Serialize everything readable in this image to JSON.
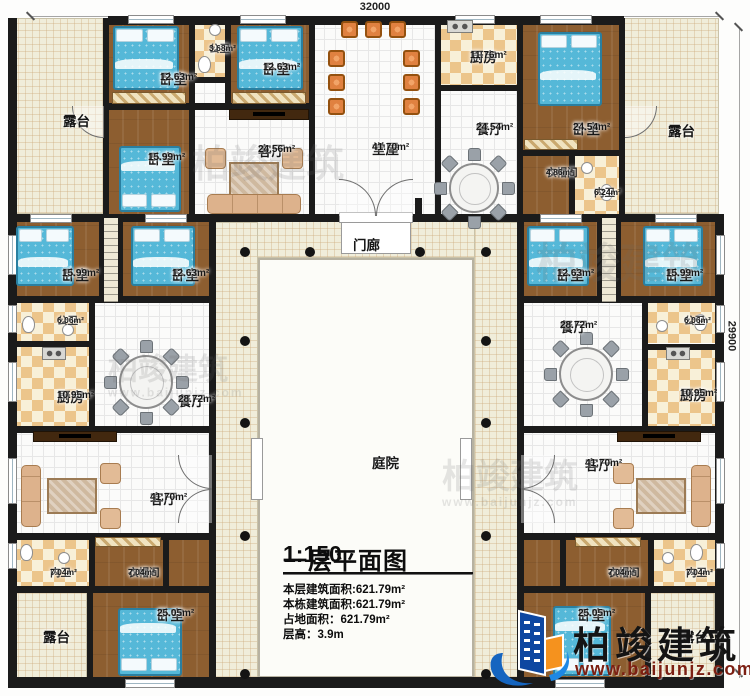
{
  "dimensions": {
    "top": "32000",
    "right": "29900"
  },
  "title_block": {
    "title": "一层平面图",
    "scale": "1:150",
    "stats": [
      "本层建筑面积:621.79m²",
      "本栋建筑面积:621.79m²",
      "占地面积：621.79m²",
      "层高：3.9m"
    ]
  },
  "logo": {
    "name": "柏竣建筑",
    "url": "www.baijunjz.com"
  },
  "watermarks": [
    {
      "x": 268,
      "y": 166,
      "size": 38,
      "with_url": false
    },
    {
      "x": 620,
      "y": 264,
      "size": 42,
      "with_url": false
    },
    {
      "x": 168,
      "y": 370,
      "size": 30,
      "with_url": true
    },
    {
      "x": 510,
      "y": 478,
      "size": 34,
      "with_url": true
    }
  ],
  "rooms": [
    {
      "name": "露台",
      "area": "",
      "type": "terrace",
      "x": 10,
      "y": 18,
      "w": 95,
      "h": 196,
      "lx": 63,
      "ly": 114
    },
    {
      "name": "卧室",
      "area": "12.63m²",
      "type": "wood",
      "x": 107,
      "y": 18,
      "w": 84,
      "h": 88,
      "lx": 160,
      "ly": 72
    },
    {
      "name": "公卫",
      "area": "3.68m²",
      "type": "checker",
      "x": 193,
      "y": 18,
      "w": 34,
      "h": 61,
      "lx": 209,
      "ly": 44,
      "small": true
    },
    {
      "name": "",
      "area": "",
      "type": "tile",
      "x": 193,
      "y": 81,
      "w": 34,
      "h": 24
    },
    {
      "name": "卧室",
      "area": "12.63m²",
      "type": "wood",
      "x": 229,
      "y": 18,
      "w": 82,
      "h": 88,
      "lx": 263,
      "ly": 62
    },
    {
      "name": "卧室",
      "area": "15.99m²",
      "type": "wood",
      "x": 107,
      "y": 108,
      "w": 84,
      "h": 108,
      "lx": 148,
      "ly": 152
    },
    {
      "name": "客厅",
      "area": "24.56m²",
      "type": "tile",
      "x": 193,
      "y": 106,
      "w": 118,
      "h": 110,
      "lx": 258,
      "ly": 144
    },
    {
      "name": "堂屋",
      "area": "41.70m²",
      "type": "tile",
      "x": 313,
      "y": 18,
      "w": 124,
      "h": 198,
      "lx": 372,
      "ly": 142
    },
    {
      "name": "厨房",
      "area": "11.76m²",
      "type": "checker",
      "x": 439,
      "y": 18,
      "w": 80,
      "h": 69,
      "lx": 470,
      "ly": 50
    },
    {
      "name": "餐厅",
      "area": "24.54m²",
      "type": "tile",
      "x": 439,
      "y": 89,
      "w": 80,
      "h": 127,
      "lx": 476,
      "ly": 122
    },
    {
      "name": "卧室",
      "area": "24.54m²",
      "type": "wood",
      "x": 521,
      "y": 18,
      "w": 100,
      "h": 134,
      "lx": 573,
      "ly": 122
    },
    {
      "name": "衣帽间",
      "area": "4.86m²",
      "type": "wood",
      "x": 521,
      "y": 156,
      "w": 50,
      "h": 60,
      "lx": 546,
      "ly": 168,
      "small": true
    },
    {
      "name": "内卫",
      "area": "6.24m²",
      "type": "checker",
      "x": 573,
      "y": 156,
      "w": 48,
      "h": 60,
      "lx": 594,
      "ly": 188,
      "small": true
    },
    {
      "name": "露台",
      "area": "",
      "type": "terrace",
      "x": 623,
      "y": 18,
      "w": 96,
      "h": 196,
      "lx": 668,
      "ly": 124
    },
    {
      "name": "门廊",
      "area": "",
      "type": "cream",
      "x": 214,
      "y": 220,
      "w": 304,
      "h": 38,
      "lx": 353,
      "ly": 238
    },
    {
      "name": "",
      "area": "",
      "type": "cream",
      "x": 214,
      "y": 222,
      "w": 44,
      "h": 456
    },
    {
      "name": "",
      "area": "",
      "type": "cream",
      "x": 474,
      "y": 222,
      "w": 44,
      "h": 456
    },
    {
      "name": "庭院",
      "area": "",
      "type": "court",
      "x": 258,
      "y": 258,
      "w": 216,
      "h": 420,
      "lx": 372,
      "ly": 456
    },
    {
      "name": "卧室",
      "area": "15.99m²",
      "type": "wood",
      "x": 10,
      "y": 220,
      "w": 89,
      "h": 78,
      "lx": 62,
      "ly": 268
    },
    {
      "name": "",
      "area": "",
      "type": "stairs",
      "x": 101,
      "y": 218,
      "w": 20,
      "h": 84
    },
    {
      "name": "卧室",
      "area": "12.63m²",
      "type": "wood",
      "x": 121,
      "y": 220,
      "w": 88,
      "h": 78,
      "lx": 172,
      "ly": 268
    },
    {
      "name": "公卫",
      "area": "6.06m²",
      "type": "checker",
      "x": 10,
      "y": 301,
      "w": 79,
      "h": 42,
      "lx": 57,
      "ly": 316,
      "small": true
    },
    {
      "name": "厨房",
      "area": "10.95m²",
      "type": "checker",
      "x": 10,
      "y": 345,
      "w": 79,
      "h": 82,
      "lx": 57,
      "ly": 390
    },
    {
      "name": "餐厅",
      "area": "28.72m²",
      "type": "tile",
      "x": 93,
      "y": 301,
      "w": 116,
      "h": 126,
      "lx": 178,
      "ly": 394
    },
    {
      "name": "卧室",
      "area": "12.63m²",
      "type": "wood",
      "x": 521,
      "y": 220,
      "w": 76,
      "h": 78,
      "lx": 557,
      "ly": 268
    },
    {
      "name": "",
      "area": "",
      "type": "stairs",
      "x": 599,
      "y": 218,
      "w": 20,
      "h": 84
    },
    {
      "name": "卧室",
      "area": "15.99m²",
      "type": "wood",
      "x": 619,
      "y": 220,
      "w": 96,
      "h": 78,
      "lx": 666,
      "ly": 268
    },
    {
      "name": "餐厅",
      "area": "28.72m²",
      "type": "tile",
      "x": 521,
      "y": 301,
      "w": 121,
      "h": 126,
      "lx": 560,
      "ly": 320
    },
    {
      "name": "公卫",
      "area": "6.06m²",
      "type": "checker",
      "x": 646,
      "y": 301,
      "w": 69,
      "h": 42,
      "lx": 684,
      "ly": 316,
      "small": true
    },
    {
      "name": "厨房",
      "area": "10.95m²",
      "type": "checker",
      "x": 646,
      "y": 347,
      "w": 69,
      "h": 80,
      "lx": 680,
      "ly": 388
    },
    {
      "name": "客厅",
      "area": "41.70m²",
      "type": "tile",
      "x": 10,
      "y": 431,
      "w": 199,
      "h": 103,
      "lx": 150,
      "ly": 492
    },
    {
      "name": "内卫",
      "area": "7.04m²",
      "type": "checker",
      "x": 10,
      "y": 538,
      "w": 79,
      "h": 49,
      "lx": 50,
      "ly": 568,
      "small": true
    },
    {
      "name": "衣帽间",
      "area": "7.04m²",
      "type": "wood",
      "x": 93,
      "y": 538,
      "w": 70,
      "h": 49,
      "lx": 128,
      "ly": 568,
      "small": true
    },
    {
      "name": "",
      "area": "",
      "type": "wood",
      "x": 167,
      "y": 538,
      "w": 42,
      "h": 49
    },
    {
      "name": "卧室",
      "area": "25.05m²",
      "type": "wood",
      "x": 91,
      "y": 591,
      "w": 118,
      "h": 88,
      "lx": 157,
      "ly": 608
    },
    {
      "name": "露台",
      "area": "",
      "type": "terrace",
      "x": 10,
      "y": 591,
      "w": 77,
      "h": 88,
      "lx": 43,
      "ly": 630
    },
    {
      "name": "客厅",
      "area": "41.70m²",
      "type": "tile",
      "x": 521,
      "y": 431,
      "w": 194,
      "h": 103,
      "lx": 585,
      "ly": 458
    },
    {
      "name": "衣帽间",
      "area": "7.04m²",
      "type": "wood",
      "x": 564,
      "y": 538,
      "w": 84,
      "h": 49,
      "lx": 608,
      "ly": 568,
      "small": true
    },
    {
      "name": "内卫",
      "area": "7.04m²",
      "type": "checker",
      "x": 652,
      "y": 538,
      "w": 63,
      "h": 49,
      "lx": 686,
      "ly": 568,
      "small": true
    },
    {
      "name": "",
      "area": "",
      "type": "wood",
      "x": 521,
      "y": 538,
      "w": 43,
      "h": 49
    },
    {
      "name": "卧室",
      "area": "25.05m²",
      "type": "wood",
      "x": 521,
      "y": 591,
      "w": 124,
      "h": 88,
      "lx": 578,
      "ly": 608
    },
    {
      "name": "露台",
      "area": "",
      "type": "terrace",
      "x": 649,
      "y": 591,
      "w": 66,
      "h": 88,
      "lx": 681,
      "ly": 630
    }
  ],
  "walls": [
    [
      108,
      16,
      516,
      9
    ],
    [
      8,
      677,
      716,
      11
    ],
    [
      8,
      18,
      9,
      659
    ],
    [
      715,
      214,
      9,
      463
    ],
    [
      8,
      214,
      716,
      8
    ],
    [
      103,
      18,
      6,
      196
    ],
    [
      189,
      18,
      6,
      196
    ],
    [
      225,
      18,
      6,
      90
    ],
    [
      309,
      18,
      6,
      196
    ],
    [
      435,
      18,
      6,
      196
    ],
    [
      517,
      18,
      6,
      196
    ],
    [
      619,
      18,
      6,
      196
    ],
    [
      569,
      152,
      6,
      64
    ],
    [
      103,
      103,
      212,
      7
    ],
    [
      189,
      77,
      42,
      6
    ],
    [
      435,
      85,
      88,
      6
    ],
    [
      517,
      150,
      108,
      6
    ],
    [
      8,
      296,
      201,
      7
    ],
    [
      517,
      296,
      204,
      7
    ],
    [
      8,
      341,
      87,
      6
    ],
    [
      642,
      344,
      79,
      6
    ],
    [
      8,
      426,
      201,
      7
    ],
    [
      517,
      426,
      204,
      7
    ],
    [
      209,
      214,
      7,
      466
    ],
    [
      517,
      214,
      7,
      466
    ],
    [
      89,
      296,
      6,
      137
    ],
    [
      642,
      296,
      6,
      137
    ],
    [
      8,
      533,
      201,
      7
    ],
    [
      517,
      533,
      204,
      7
    ],
    [
      8,
      586,
      201,
      7
    ],
    [
      517,
      586,
      204,
      7
    ],
    [
      89,
      533,
      6,
      60
    ],
    [
      163,
      533,
      6,
      60
    ],
    [
      87,
      586,
      6,
      94
    ],
    [
      560,
      533,
      6,
      60
    ],
    [
      648,
      533,
      6,
      60
    ],
    [
      645,
      586,
      6,
      94
    ],
    [
      99,
      214,
      4,
      88
    ],
    [
      119,
      214,
      4,
      88
    ],
    [
      597,
      214,
      4,
      88
    ],
    [
      617,
      214,
      4,
      88
    ],
    [
      415,
      198,
      7,
      20
    ]
  ],
  "windows_h": [
    [
      128,
      15,
      46
    ],
    [
      240,
      15,
      46
    ],
    [
      455,
      15,
      40
    ],
    [
      540,
      15,
      52
    ],
    [
      125,
      679,
      50
    ],
    [
      555,
      679,
      50
    ],
    [
      30,
      214,
      42
    ],
    [
      145,
      214,
      42
    ],
    [
      540,
      214,
      42
    ],
    [
      655,
      214,
      42
    ]
  ],
  "windows_v": [
    [
      8,
      235,
      40
    ],
    [
      8,
      305,
      28
    ],
    [
      8,
      362,
      40
    ],
    [
      8,
      458,
      46
    ],
    [
      8,
      543,
      26
    ],
    [
      716,
      235,
      40
    ],
    [
      716,
      305,
      28
    ],
    [
      716,
      362,
      40
    ],
    [
      716,
      458,
      46
    ],
    [
      716,
      543,
      26
    ]
  ],
  "doors": [
    {
      "x": 339,
      "y": 179,
      "s": 37,
      "c": "tr"
    },
    {
      "x": 376,
      "y": 179,
      "s": 37,
      "c": "tl"
    },
    {
      "x": 178,
      "y": 455,
      "s": 34,
      "c": "bl"
    },
    {
      "x": 178,
      "y": 489,
      "s": 34,
      "c": "tl"
    },
    {
      "x": 521,
      "y": 455,
      "s": 34,
      "c": "br"
    },
    {
      "x": 521,
      "y": 489,
      "s": 34,
      "c": "tr"
    },
    {
      "x": 72,
      "y": 106,
      "s": 32,
      "c": "bl"
    },
    {
      "x": 625,
      "y": 106,
      "s": 32,
      "c": "br"
    }
  ],
  "gaps": [
    [
      339,
      212,
      74,
      11
    ],
    [
      341,
      222,
      70,
      32
    ],
    [
      251,
      438,
      12,
      62
    ],
    [
      460,
      438,
      12,
      62
    ]
  ],
  "dots": [
    [
      245,
      252
    ],
    [
      245,
      341
    ],
    [
      245,
      423
    ],
    [
      245,
      536
    ],
    [
      245,
      674
    ],
    [
      486,
      252
    ],
    [
      486,
      341
    ],
    [
      486,
      423
    ],
    [
      486,
      536
    ],
    [
      486,
      674
    ],
    [
      310,
      252
    ],
    [
      420,
      252
    ]
  ],
  "furniture": [
    {
      "k": "bed",
      "x": 113,
      "y": 26,
      "w": 66,
      "h": 64,
      "p": "t"
    },
    {
      "k": "bed",
      "x": 237,
      "y": 26,
      "w": 66,
      "h": 64,
      "p": "t"
    },
    {
      "k": "bed",
      "x": 119,
      "y": 146,
      "w": 62,
      "h": 66,
      "p": "b"
    },
    {
      "k": "bed",
      "x": 538,
      "y": 32,
      "w": 64,
      "h": 74,
      "p": "t"
    },
    {
      "k": "bed",
      "x": 16,
      "y": 226,
      "w": 58,
      "h": 60,
      "p": "t"
    },
    {
      "k": "bed",
      "x": 131,
      "y": 226,
      "w": 64,
      "h": 60,
      "p": "t"
    },
    {
      "k": "bed",
      "x": 527,
      "y": 226,
      "w": 62,
      "h": 60,
      "p": "t"
    },
    {
      "k": "bed",
      "x": 643,
      "y": 226,
      "w": 60,
      "h": 60,
      "p": "t"
    },
    {
      "k": "bed",
      "x": 118,
      "y": 608,
      "w": 64,
      "h": 68,
      "p": "b"
    },
    {
      "k": "bed",
      "x": 553,
      "y": 606,
      "w": 58,
      "h": 70,
      "p": "b"
    },
    {
      "k": "din",
      "cx": 474,
      "cy": 188,
      "r": 25
    },
    {
      "k": "din",
      "cx": 146,
      "cy": 382,
      "r": 27
    },
    {
      "k": "din",
      "cx": 586,
      "cy": 374,
      "r": 27
    },
    {
      "k": "sofa",
      "x": 203,
      "y": 146,
      "w": 102,
      "h": 68,
      "side": "b"
    },
    {
      "k": "sofa",
      "x": 21,
      "y": 461,
      "w": 102,
      "h": 70,
      "side": "l"
    },
    {
      "k": "sofa",
      "x": 611,
      "y": 461,
      "w": 100,
      "h": 70,
      "side": "r"
    },
    {
      "k": "tv",
      "x": 229,
      "y": 109,
      "w": 80,
      "h": 11
    },
    {
      "k": "tv",
      "x": 33,
      "y": 431,
      "w": 84,
      "h": 11
    },
    {
      "k": "tv",
      "x": 617,
      "y": 431,
      "w": 84,
      "h": 11
    },
    {
      "k": "ch",
      "x": 341,
      "y": 21
    },
    {
      "k": "ch",
      "x": 365,
      "y": 21
    },
    {
      "k": "ch",
      "x": 389,
      "y": 21
    },
    {
      "k": "ch",
      "x": 328,
      "y": 50
    },
    {
      "k": "ch",
      "x": 328,
      "y": 74
    },
    {
      "k": "ch",
      "x": 328,
      "y": 98
    },
    {
      "k": "ch",
      "x": 403,
      "y": 50
    },
    {
      "k": "ch",
      "x": 403,
      "y": 74
    },
    {
      "k": "ch",
      "x": 403,
      "y": 98
    },
    {
      "k": "stove",
      "x": 447,
      "y": 20,
      "w": 26,
      "h": 13
    },
    {
      "k": "stove",
      "x": 42,
      "y": 347,
      "w": 24,
      "h": 13
    },
    {
      "k": "stove",
      "x": 666,
      "y": 347,
      "w": 24,
      "h": 13
    },
    {
      "k": "wc",
      "x": 198,
      "y": 56
    },
    {
      "k": "wc",
      "x": 600,
      "y": 184
    },
    {
      "k": "wc",
      "x": 22,
      "y": 316
    },
    {
      "k": "wc",
      "x": 20,
      "y": 544
    },
    {
      "k": "wc",
      "x": 694,
      "y": 314
    },
    {
      "k": "wc",
      "x": 690,
      "y": 544
    },
    {
      "k": "sink",
      "x": 209,
      "y": 24
    },
    {
      "k": "sink",
      "x": 581,
      "y": 162
    },
    {
      "k": "sink",
      "x": 62,
      "y": 324
    },
    {
      "k": "sink",
      "x": 58,
      "y": 552
    },
    {
      "k": "sink",
      "x": 656,
      "y": 320
    },
    {
      "k": "sink",
      "x": 662,
      "y": 552
    },
    {
      "k": "hatch",
      "x": 112,
      "y": 92,
      "w": 74,
      "h": 12
    },
    {
      "k": "hatch",
      "x": 232,
      "y": 92,
      "w": 74,
      "h": 12
    },
    {
      "k": "hatch",
      "x": 95,
      "y": 537,
      "w": 66,
      "h": 10
    },
    {
      "k": "hatch",
      "x": 575,
      "y": 537,
      "w": 66,
      "h": 10
    },
    {
      "k": "hatch",
      "x": 524,
      "y": 139,
      "w": 54,
      "h": 11
    }
  ]
}
